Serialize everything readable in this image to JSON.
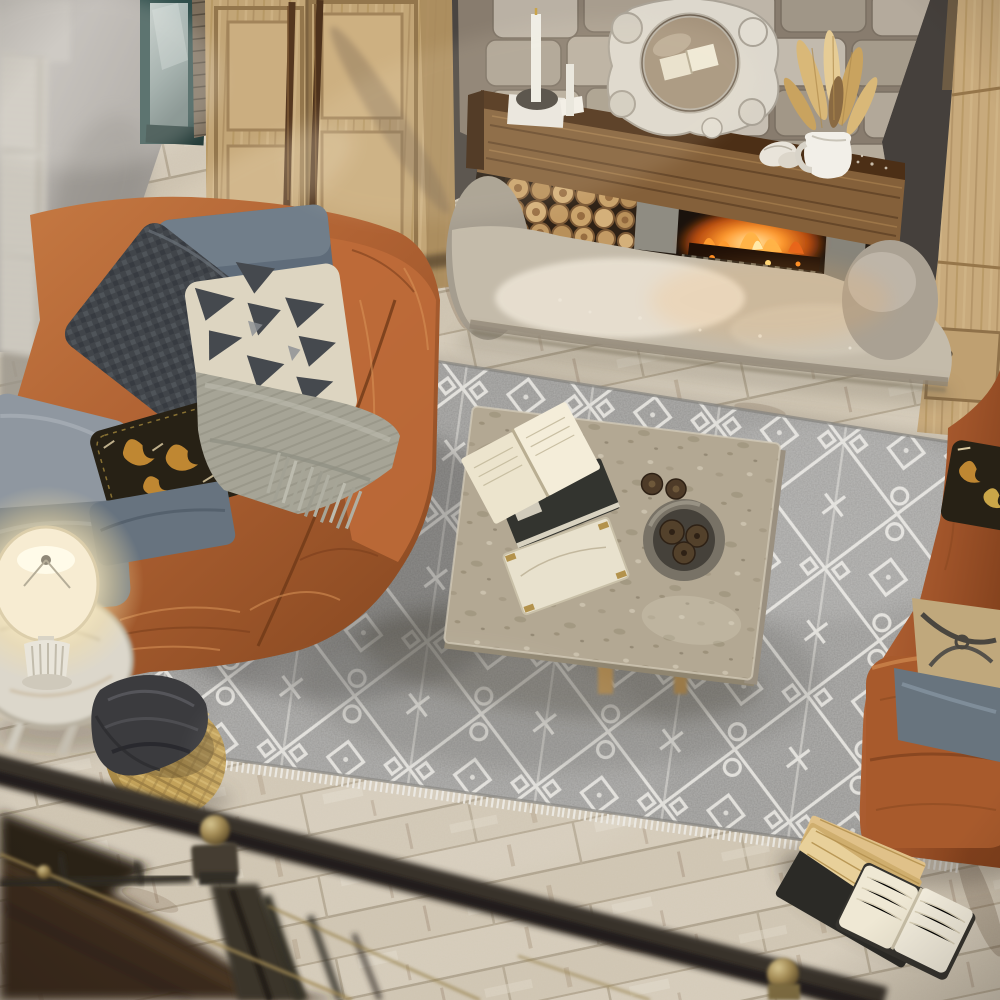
{
  "meta": {
    "type": "product-photograph",
    "caption": "Overhead view of a rustic living room: gray Moroccan trellis area rug between two cognac leather sofas, stone fireplace with rustic wood mantel, whitewashed plank floor, seen from behind a dark metal loft railing",
    "width_px": 1000,
    "height_px": 1000
  },
  "palette": {
    "floor_light": "#d8cfbf",
    "floor_mid": "#c7bca8",
    "floor_streak": "#7e624a",
    "rug_gray": "#969593",
    "rug_light": "#b3b1ae",
    "rug_pattern": "#e7e5e0",
    "leather": "#b06233",
    "leather_light": "#d08a50",
    "leather_dark": "#7c3f1d",
    "throw": "#a6a496",
    "denim": "#5f6c7a",
    "charcoal_pillow": "#41454a",
    "cream_pillow": "#ddd5c1",
    "pillow_motif": "#45494e",
    "ikat_black": "#272115",
    "ikat_gold": "#bf8732",
    "stone_light": "#c8c0b2",
    "mortar": "#8d8273",
    "wall_dark": "#45403c",
    "plaster": "#b4b0ab",
    "wood_wardrobe": "#c2a576",
    "beam_face": "#84603a",
    "beam_top": "#4c2f16",
    "hearth": "#c4bbaa",
    "hearth_light": "#ece4d5",
    "fire": "#ff8c22",
    "fire_core": "#ffd97c",
    "firebox": "#1a120c",
    "table_stone": "#b3a893",
    "lamp_glow": "#fff3cf",
    "white_ceramic": "#efece4",
    "basket": "#c2a159",
    "fabric_dark": "#3b3b3e",
    "metal_rail": "#37322b",
    "brass": "#a28a54",
    "stair_wood": "#3a2b1c",
    "book_pages": "#e8ddbe",
    "book_tan": "#d9b87a",
    "glass_teal": "#2f4e4b",
    "glass": "#aab7b4",
    "shutter": "#d7d3c9"
  },
  "objects": [
    {
      "id": "floor",
      "label": "whitewashed plank floor"
    },
    {
      "id": "area-rug",
      "label": "gray Moroccan trellis rug with white pattern and fringe"
    },
    {
      "id": "left-sofa",
      "label": "cognac leather sofa (left)"
    },
    {
      "id": "right-sofa",
      "label": "cognac leather sofa (right)"
    },
    {
      "id": "throw-blanket",
      "label": "gray knit fringe throw"
    },
    {
      "id": "pillows",
      "label": "denim, houndstooth, cream kilim, black-gold ikat and gray pillows"
    },
    {
      "id": "coffee-table",
      "label": "square travertine coffee table"
    },
    {
      "id": "stone-bowl",
      "label": "stone bowl with pinecones"
    },
    {
      "id": "fireplace",
      "label": "stone fireplace with rustic beam mantel, firewood and burning insert"
    },
    {
      "id": "mantel-mirror",
      "label": "ornate white baroque mirror"
    },
    {
      "id": "pitcher-with-pampas",
      "label": "white pitcher with dried pampas"
    },
    {
      "id": "candle-set",
      "label": "taper candles on stand"
    },
    {
      "id": "wardrobe",
      "label": "light wood wardrobe with long pulls"
    },
    {
      "id": "glass-door",
      "label": "teal framed glass door"
    },
    {
      "id": "window-shutters",
      "label": "white louvered shutters"
    },
    {
      "id": "side-table",
      "label": "distressed white side table"
    },
    {
      "id": "table-lamp",
      "label": "lit table lamp with cream shade"
    },
    {
      "id": "storage-basket",
      "label": "woven jute basket with dark fabric"
    },
    {
      "id": "floor-books",
      "label": "open books lying on rug edge"
    },
    {
      "id": "stair-railing",
      "label": "dark metal loft railing with brass details (foreground)"
    }
  ]
}
